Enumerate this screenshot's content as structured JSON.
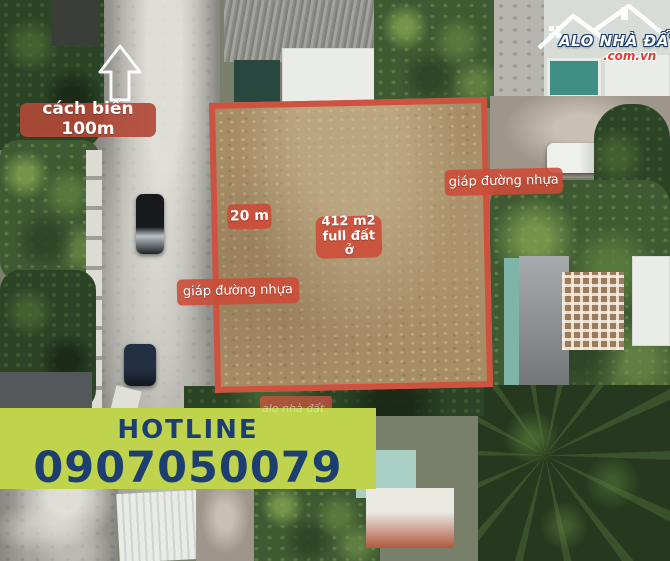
{
  "overlay": {
    "distance_label": "cách biển 100m",
    "plot": {
      "area_line1": "412 m2",
      "area_line2": "full đất ở",
      "width_label": "20 m",
      "road_label_left": "giáp đường nhựa",
      "road_label_right": "giáp đường nhựa"
    },
    "watermark": "alo nhà đất"
  },
  "logo": {
    "title": "ALO NHÀ ĐẤT",
    "domain": ".com.vn"
  },
  "hotline": {
    "label": "HOTLINE",
    "number": "0907050079"
  },
  "icons": {
    "beach_direction": "arrow-up-icon",
    "logo_house": "house-roof-icon",
    "logo_window": "window-grid-icon"
  },
  "colors": {
    "plot_border": "#cf5240",
    "label_bg": "#ce4a37",
    "banner_bg": "#c0d34d",
    "banner_text": "#1d3e70",
    "logo_text": "#ffffff",
    "logo_domain": "#e23d30"
  }
}
